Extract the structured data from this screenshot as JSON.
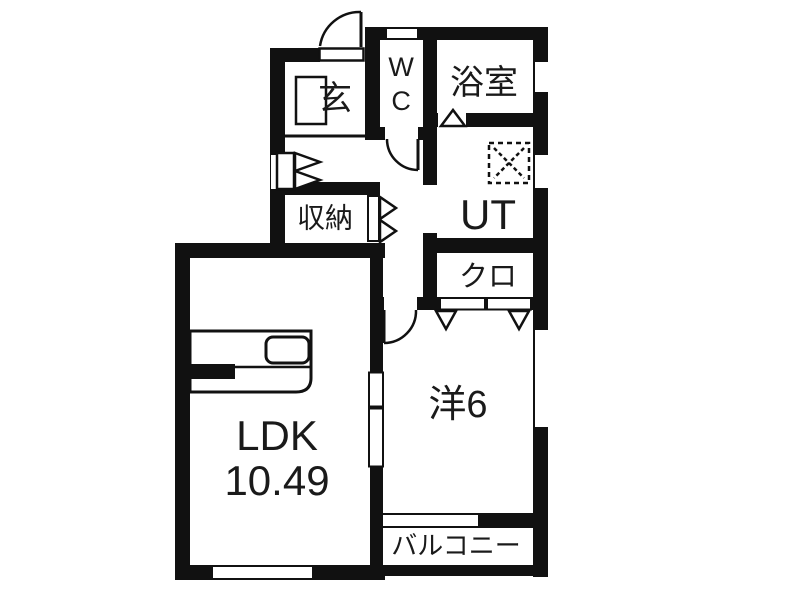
{
  "title": "1LDK apartment floor plan",
  "colors": {
    "wall": "#111111",
    "floor": "#ffffff",
    "text": "#1a1a1a"
  },
  "rooms": {
    "genkan": {
      "label": "玄"
    },
    "wc": {
      "label": "WC"
    },
    "bath": {
      "label": "浴室"
    },
    "storage": {
      "label": "収納"
    },
    "utility": {
      "label": "UT"
    },
    "closet": {
      "label": "クロ"
    },
    "ldk": {
      "label": "LDK",
      "area": "10.49"
    },
    "western": {
      "label": "洋6"
    },
    "balcony": {
      "label": "バルコニー"
    }
  }
}
